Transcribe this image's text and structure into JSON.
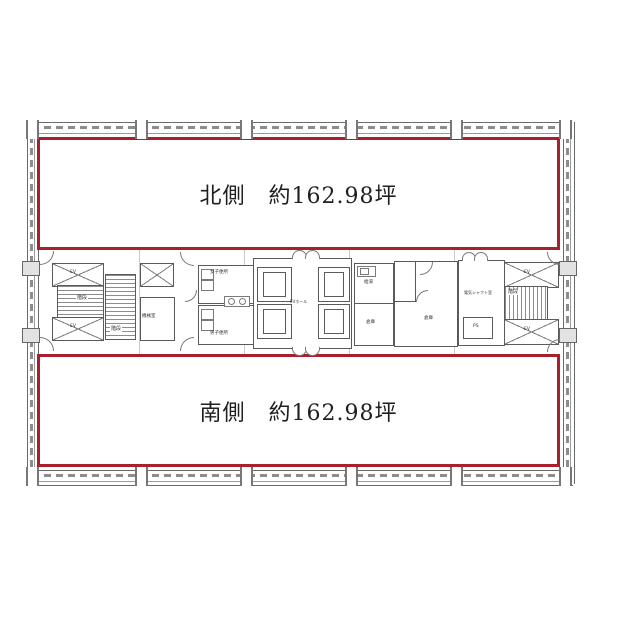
{
  "plan": {
    "areas": {
      "north": {
        "label": "北側　約162.98坪"
      },
      "south": {
        "label": "南側　約162.98坪"
      }
    },
    "core": {
      "stair_label": "階段",
      "machine_room": "機械室",
      "womens_toilet": "女子便所",
      "mens_toilet": "男子便所",
      "elevator_hall": "EVホール",
      "kitchenette": "給湯",
      "storage": "倉庫",
      "electrical_shaft_room": "電気シャフト室",
      "pipe_space": "PS",
      "elevator": "EV"
    },
    "colors": {
      "tenant_area_border": "#a8202e",
      "wall_line": "#5a5a5a",
      "hatch_line": "#8c8c8c"
    }
  }
}
